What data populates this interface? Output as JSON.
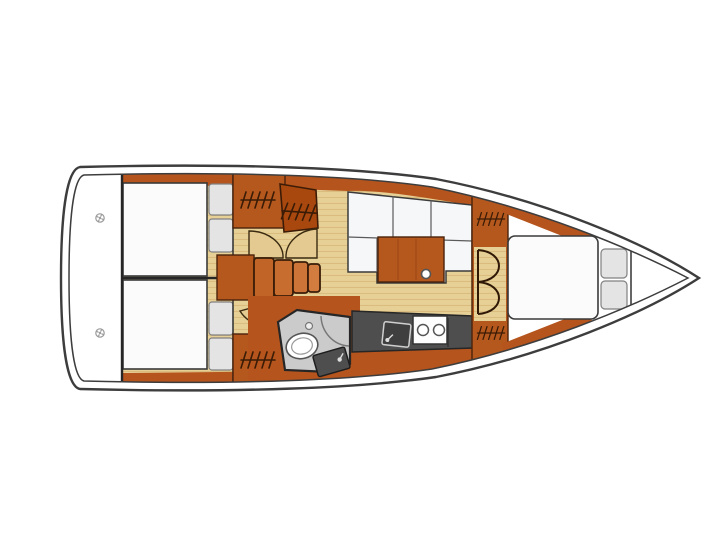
{
  "plan": {
    "type": "sailboat-interior-floor-plan-top-view",
    "orientation": {
      "bow": "right",
      "stern": "left"
    },
    "colors": {
      "background": "#ffffff",
      "hull_outline": "#3d3d3d",
      "deck_white": "#ffffff",
      "sole_wood": "#e7d096",
      "sole_grain": "#d8bb7c",
      "furniture_wood": "#b5581e",
      "furniture_wood_dark": "#a8480f",
      "furniture_trim": "#4a230a",
      "door_swing": "#e4ca90",
      "berth_white": "#fbfbfb",
      "cushion_grey": "#e4e4e4",
      "galley_counter": "#4e4e4e",
      "head_floor": "#cbcbcb",
      "fixture_white": "#ffffff"
    },
    "rooms": {
      "transom": {
        "name": "stern transom / cockpit locker area",
        "deck_fittings": 2
      },
      "aft_cabin_top": {
        "name": "aft double cabin (upper)",
        "features": [
          "double berth",
          "2 pillows",
          "hanging locker",
          "door swing"
        ]
      },
      "aft_cabin_bottom": {
        "name": "aft double cabin (lower)",
        "features": [
          "double berth",
          "2 pillows",
          "hanging locker",
          "door swing"
        ]
      },
      "companionway": {
        "name": "companionway steps",
        "step_count": 4
      },
      "saloon": {
        "name": "saloon",
        "features": [
          "L-settee with 3 back cushions",
          "wood table",
          "cup holder"
        ]
      },
      "galley": {
        "name": "galley",
        "features": [
          "sink with faucet",
          "2-burner stove",
          "dark worktop"
        ]
      },
      "head": {
        "name": "head / wet room",
        "features": [
          "toilet",
          "vanity sink",
          "shower door arc",
          "door swing"
        ]
      },
      "forward_cabin": {
        "name": "forward V-berth cabin",
        "features": [
          "double berth",
          "2 pillows",
          "bi-fold door",
          "2 hanging lockers"
        ]
      }
    },
    "symbols": {
      "hanging_locker_hatches": 5,
      "door_swings": 5,
      "stern_deck_fittings": 2
    }
  }
}
